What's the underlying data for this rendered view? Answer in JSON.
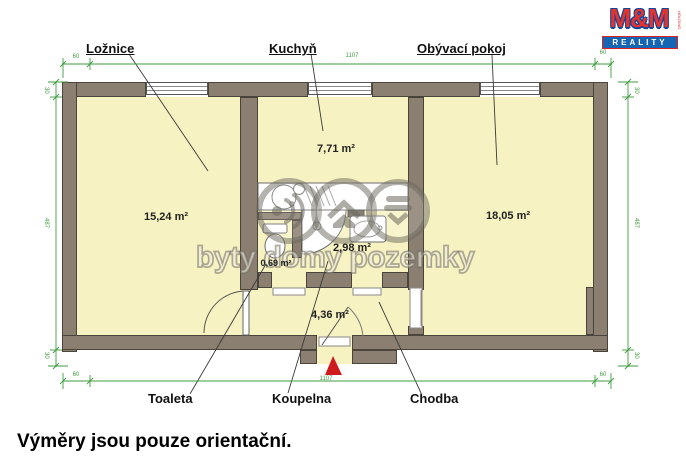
{
  "footer_note": "Výměry jsou pouze orientační.",
  "logo": {
    "name": "M&M",
    "sub": "REALITY",
    "side": "HOLDING"
  },
  "watermark": {
    "text": "byty domy pozemky"
  },
  "rooms": {
    "loznice": {
      "label": "Ložnice",
      "area": "15,24 m²"
    },
    "kuchyn": {
      "label": "Kuchyň",
      "area": "7,71 m²"
    },
    "obyvaci_pokoj": {
      "label": "Obývací pokoj",
      "area": "18,05 m²"
    },
    "toaleta": {
      "label": "Toaleta",
      "area": "0,69 m²"
    },
    "koupelna": {
      "label": "Koupelna",
      "area": "2,98 m²"
    },
    "chodba": {
      "label": "Chodba",
      "area": "4,36 m²"
    }
  },
  "dimensions": {
    "top": {
      "left": "60",
      "main": "1107",
      "right": "60"
    },
    "bottom": {
      "left": "60",
      "main": "1107",
      "right": "60"
    },
    "left": {
      "top": "30",
      "main": "487",
      "bottom": "30"
    },
    "right": {
      "top": "30",
      "main": "487",
      "bottom": "30"
    }
  },
  "colors": {
    "wall": "#8a7f70",
    "room_fill": "#f7f2c2",
    "dimension_green": "#3f9b3f",
    "entrance_arrow_red": "#cf1b1b",
    "logo_red": "#e5332d",
    "logo_blue": "#1565b4"
  }
}
